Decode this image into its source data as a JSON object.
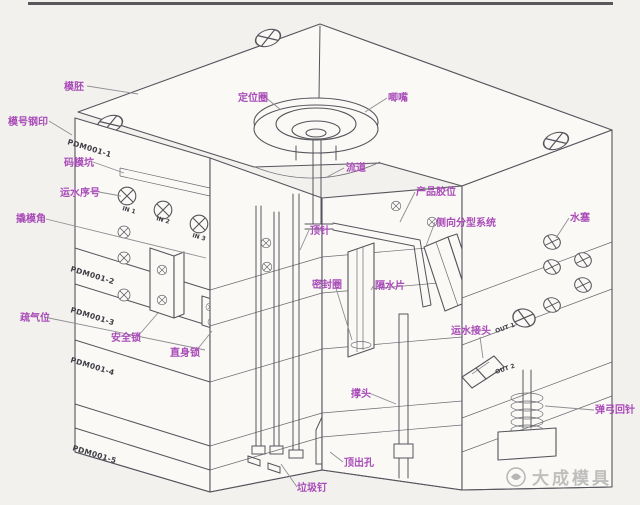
{
  "diagram": {
    "type": "injection-mold-structure-cutaway",
    "part_labels": [
      {
        "text": "模胚"
      },
      {
        "text": "模号钢印"
      },
      {
        "text": "码模坑"
      },
      {
        "text": "运水序号"
      },
      {
        "text": "撬模角"
      },
      {
        "text": "疏气位"
      },
      {
        "text": "安全锁"
      },
      {
        "text": "直身锁"
      },
      {
        "text": "定位圈"
      },
      {
        "text": "唧嘴"
      },
      {
        "text": "流道"
      },
      {
        "text": "产品胶位"
      },
      {
        "text": "侧向分型系统"
      },
      {
        "text": "顶针"
      },
      {
        "text": "密封圈"
      },
      {
        "text": "隔水片"
      },
      {
        "text": "水塞"
      },
      {
        "text": "运水接头"
      },
      {
        "text": "弹弓回针"
      },
      {
        "text": "撑头"
      },
      {
        "text": "顶出孔"
      },
      {
        "text": "垃圾钉"
      }
    ],
    "plate_labels": [
      {
        "text": "PDM001-1"
      },
      {
        "text": "PDM001-2"
      },
      {
        "text": "PDM001-3"
      },
      {
        "text": "PDM001-4"
      },
      {
        "text": "PDM001-5"
      }
    ],
    "port_labels": [
      {
        "text": "IN 1"
      },
      {
        "text": "IN 2"
      },
      {
        "text": "IN 3"
      },
      {
        "text": "OUT 1"
      },
      {
        "text": "OUT 2"
      }
    ],
    "colors": {
      "label": "#a94cb8",
      "line": "#55555c",
      "background": "#f3f1ee"
    }
  },
  "watermark": {
    "text": "大成模具",
    "logo": "circle-logo"
  }
}
